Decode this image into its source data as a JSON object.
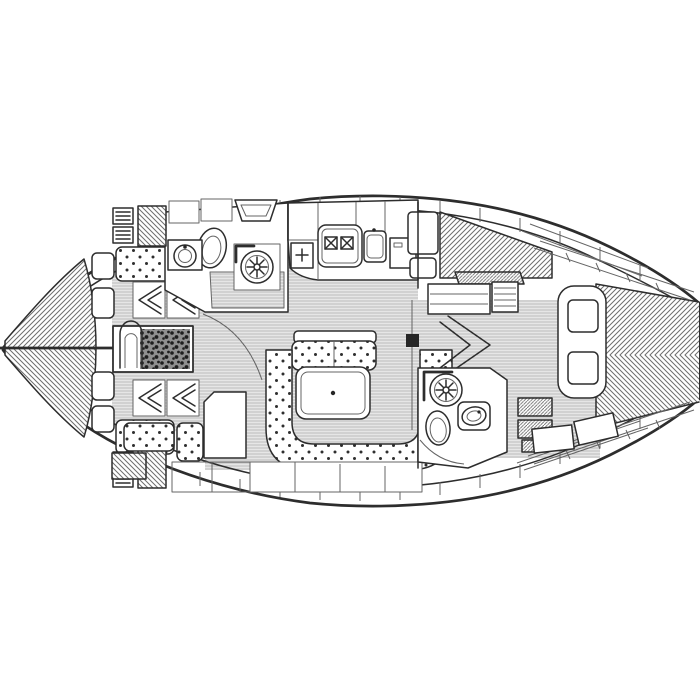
{
  "page": {
    "background": "#ffffff"
  },
  "colors": {
    "paper": "#ffffff",
    "line": "#2d2d2d",
    "line-soft": "#646464",
    "sole-bg": "#e6e6e6",
    "sole-line": "#bcbcbc",
    "hatch": "#6e6e6e",
    "dot": "#2f2f2f",
    "dark-fill": "#262626"
  },
  "plan": {
    "type": "sailing-yacht-interior-floor-plan",
    "view": "top-down line drawing",
    "bow_direction": "left",
    "areas": {
      "v_berth": {
        "label": "forward V-berth with hatched mattresses"
      },
      "forward_cabin": {
        "label": "forward cabin with benches, wardrobes and vanity"
      },
      "forward_head": {
        "label": "forward head with toilet, washbasin and shower"
      },
      "galley": {
        "label": "galley with two-burner stove, sink and refrigerator"
      },
      "salon": {
        "label": "salon with U-shaped settee, bench and folding table"
      },
      "nav_station": {
        "label": "navigation station"
      },
      "port_aft_berth": {
        "label": "port aft berth with lockers"
      },
      "aft_head": {
        "label": "aft head with toilet, washbasin and shower"
      },
      "companionway": {
        "label": "companionway steps"
      },
      "aft_cabin": {
        "label": "aft double-berth cabin with pillows"
      },
      "hull": {
        "label": "hull outline with side decks"
      }
    },
    "fixtures": [
      "toilet",
      "washbasin",
      "shower-drain-rosette",
      "two-burner-stove",
      "galley-sink",
      "refrigerator",
      "saloon-table",
      "mast-post",
      "wardrobe-hanging-locker",
      "deck-hatch",
      "locker-shelves",
      "step-treads"
    ]
  }
}
